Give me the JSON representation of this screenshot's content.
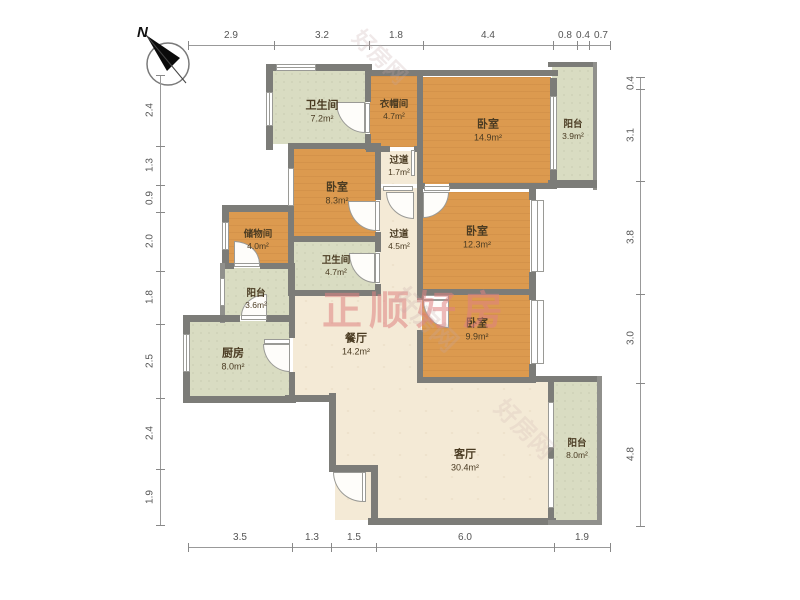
{
  "compass": {
    "label": "N"
  },
  "watermark": {
    "main": "正顺好房",
    "faint": "好房网"
  },
  "colors": {
    "wall": "#7c7c78",
    "wood": "#dc9a4f",
    "tile": "#d9dcc2",
    "floor": "#f4ead6",
    "watermark": "#e28686"
  },
  "rooms": [
    {
      "name": "卫生间",
      "area": "7.2m²"
    },
    {
      "name": "衣帽间",
      "area": "4.7m²"
    },
    {
      "name": "卧室",
      "area": "14.9m²"
    },
    {
      "name": "阳台",
      "area": "3.9m²"
    },
    {
      "name": "卧室",
      "area": "8.3m²"
    },
    {
      "name": "过道",
      "area": "1.7m²"
    },
    {
      "name": "过道",
      "area": "4.5m²"
    },
    {
      "name": "卧室",
      "area": "12.3m²"
    },
    {
      "name": "储物间",
      "area": "4.0m²"
    },
    {
      "name": "卫生间",
      "area": "4.7m²"
    },
    {
      "name": "阳台",
      "area": "3.6m²"
    },
    {
      "name": "厨房",
      "area": "8.0m²"
    },
    {
      "name": "餐厅",
      "area": "14.2m²"
    },
    {
      "name": "卧室",
      "area": "9.9m²"
    },
    {
      "name": "客厅",
      "area": "30.4m²"
    },
    {
      "name": "阳台",
      "area": "8.0m²"
    }
  ],
  "dims": {
    "top": [
      "2.9",
      "3.2",
      "1.8",
      "4.4",
      "0.8",
      "0.4",
      "0.7"
    ],
    "left": [
      "2.4",
      "1.3",
      "0.9",
      "2.0",
      "1.8",
      "2.5",
      "2.4",
      "1.9"
    ],
    "right": [
      "0.4",
      "3.1",
      "3.8",
      "3.0",
      "4.8"
    ],
    "bottom": [
      "3.5",
      "1.3",
      "1.5",
      "6.0",
      "1.9"
    ]
  }
}
